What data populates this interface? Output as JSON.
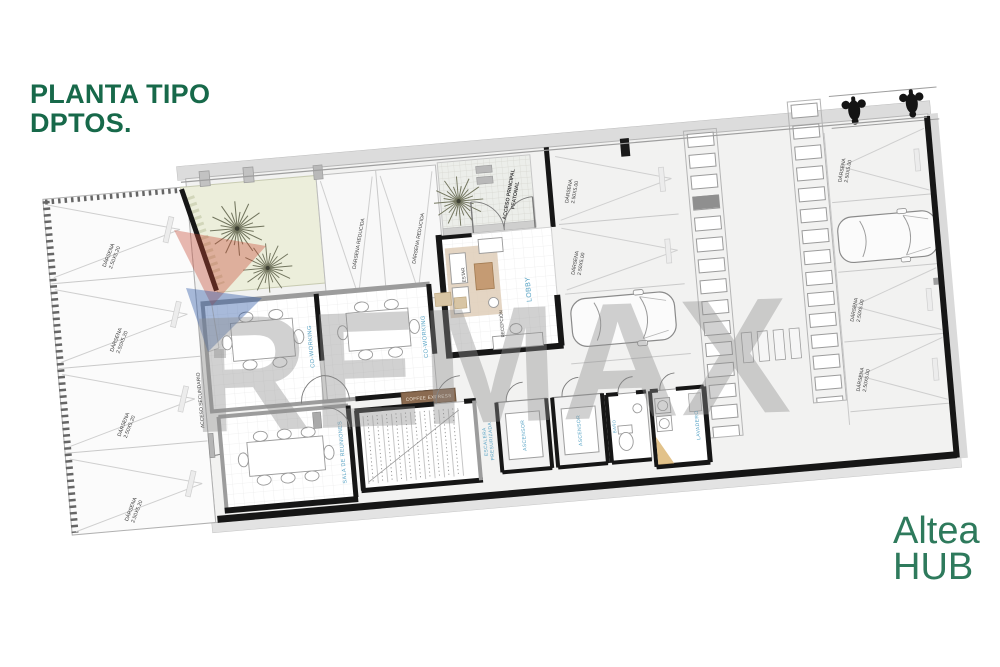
{
  "header": {
    "title_line1": "PLANTA TIPO",
    "title_line2": "DPTOS.",
    "title_color": "#17694a"
  },
  "brand": {
    "name_top": "Altea",
    "name_bottom": "HUB",
    "color": "#2e7a5c"
  },
  "watermark": {
    "text": "REMAX",
    "text_color": "#8f8f8f",
    "balloon_red": "#c94a35",
    "balloon_blue": "#2f5ba6"
  },
  "plan": {
    "room_label_color": "#55a2c4",
    "dark_label_color": "#3a3a3a",
    "wall_color": "#161616",
    "garden_color": "#eceedb",
    "labels": {
      "coworking": "CO-WORKING",
      "coffee_express": "COFFEE EXPRESS",
      "sala_reuniones": "SALA DE REUNIONES",
      "acceso_secundario": "ACCESO SECUNDARIO",
      "acceso_principal_1": "ACCESO PRINCIPAL",
      "acceso_principal_2": "PEATONAL",
      "escalera_1": "ESCALERA",
      "escalera_2": "PRESURIZADA",
      "ascensor": "ASCENSOR",
      "lavadero": "LAVADERO",
      "banio": "BAÑO",
      "lobby": "LOBBY",
      "estar": "ESTAR",
      "recepcion": "RECEPCIÓN",
      "darsena": "DÁRSENA",
      "darsena_reducida": "DÁRSENA REDUCIDA",
      "size_large": "2.50X5.20",
      "size_std": "2.50X5.00"
    }
  }
}
